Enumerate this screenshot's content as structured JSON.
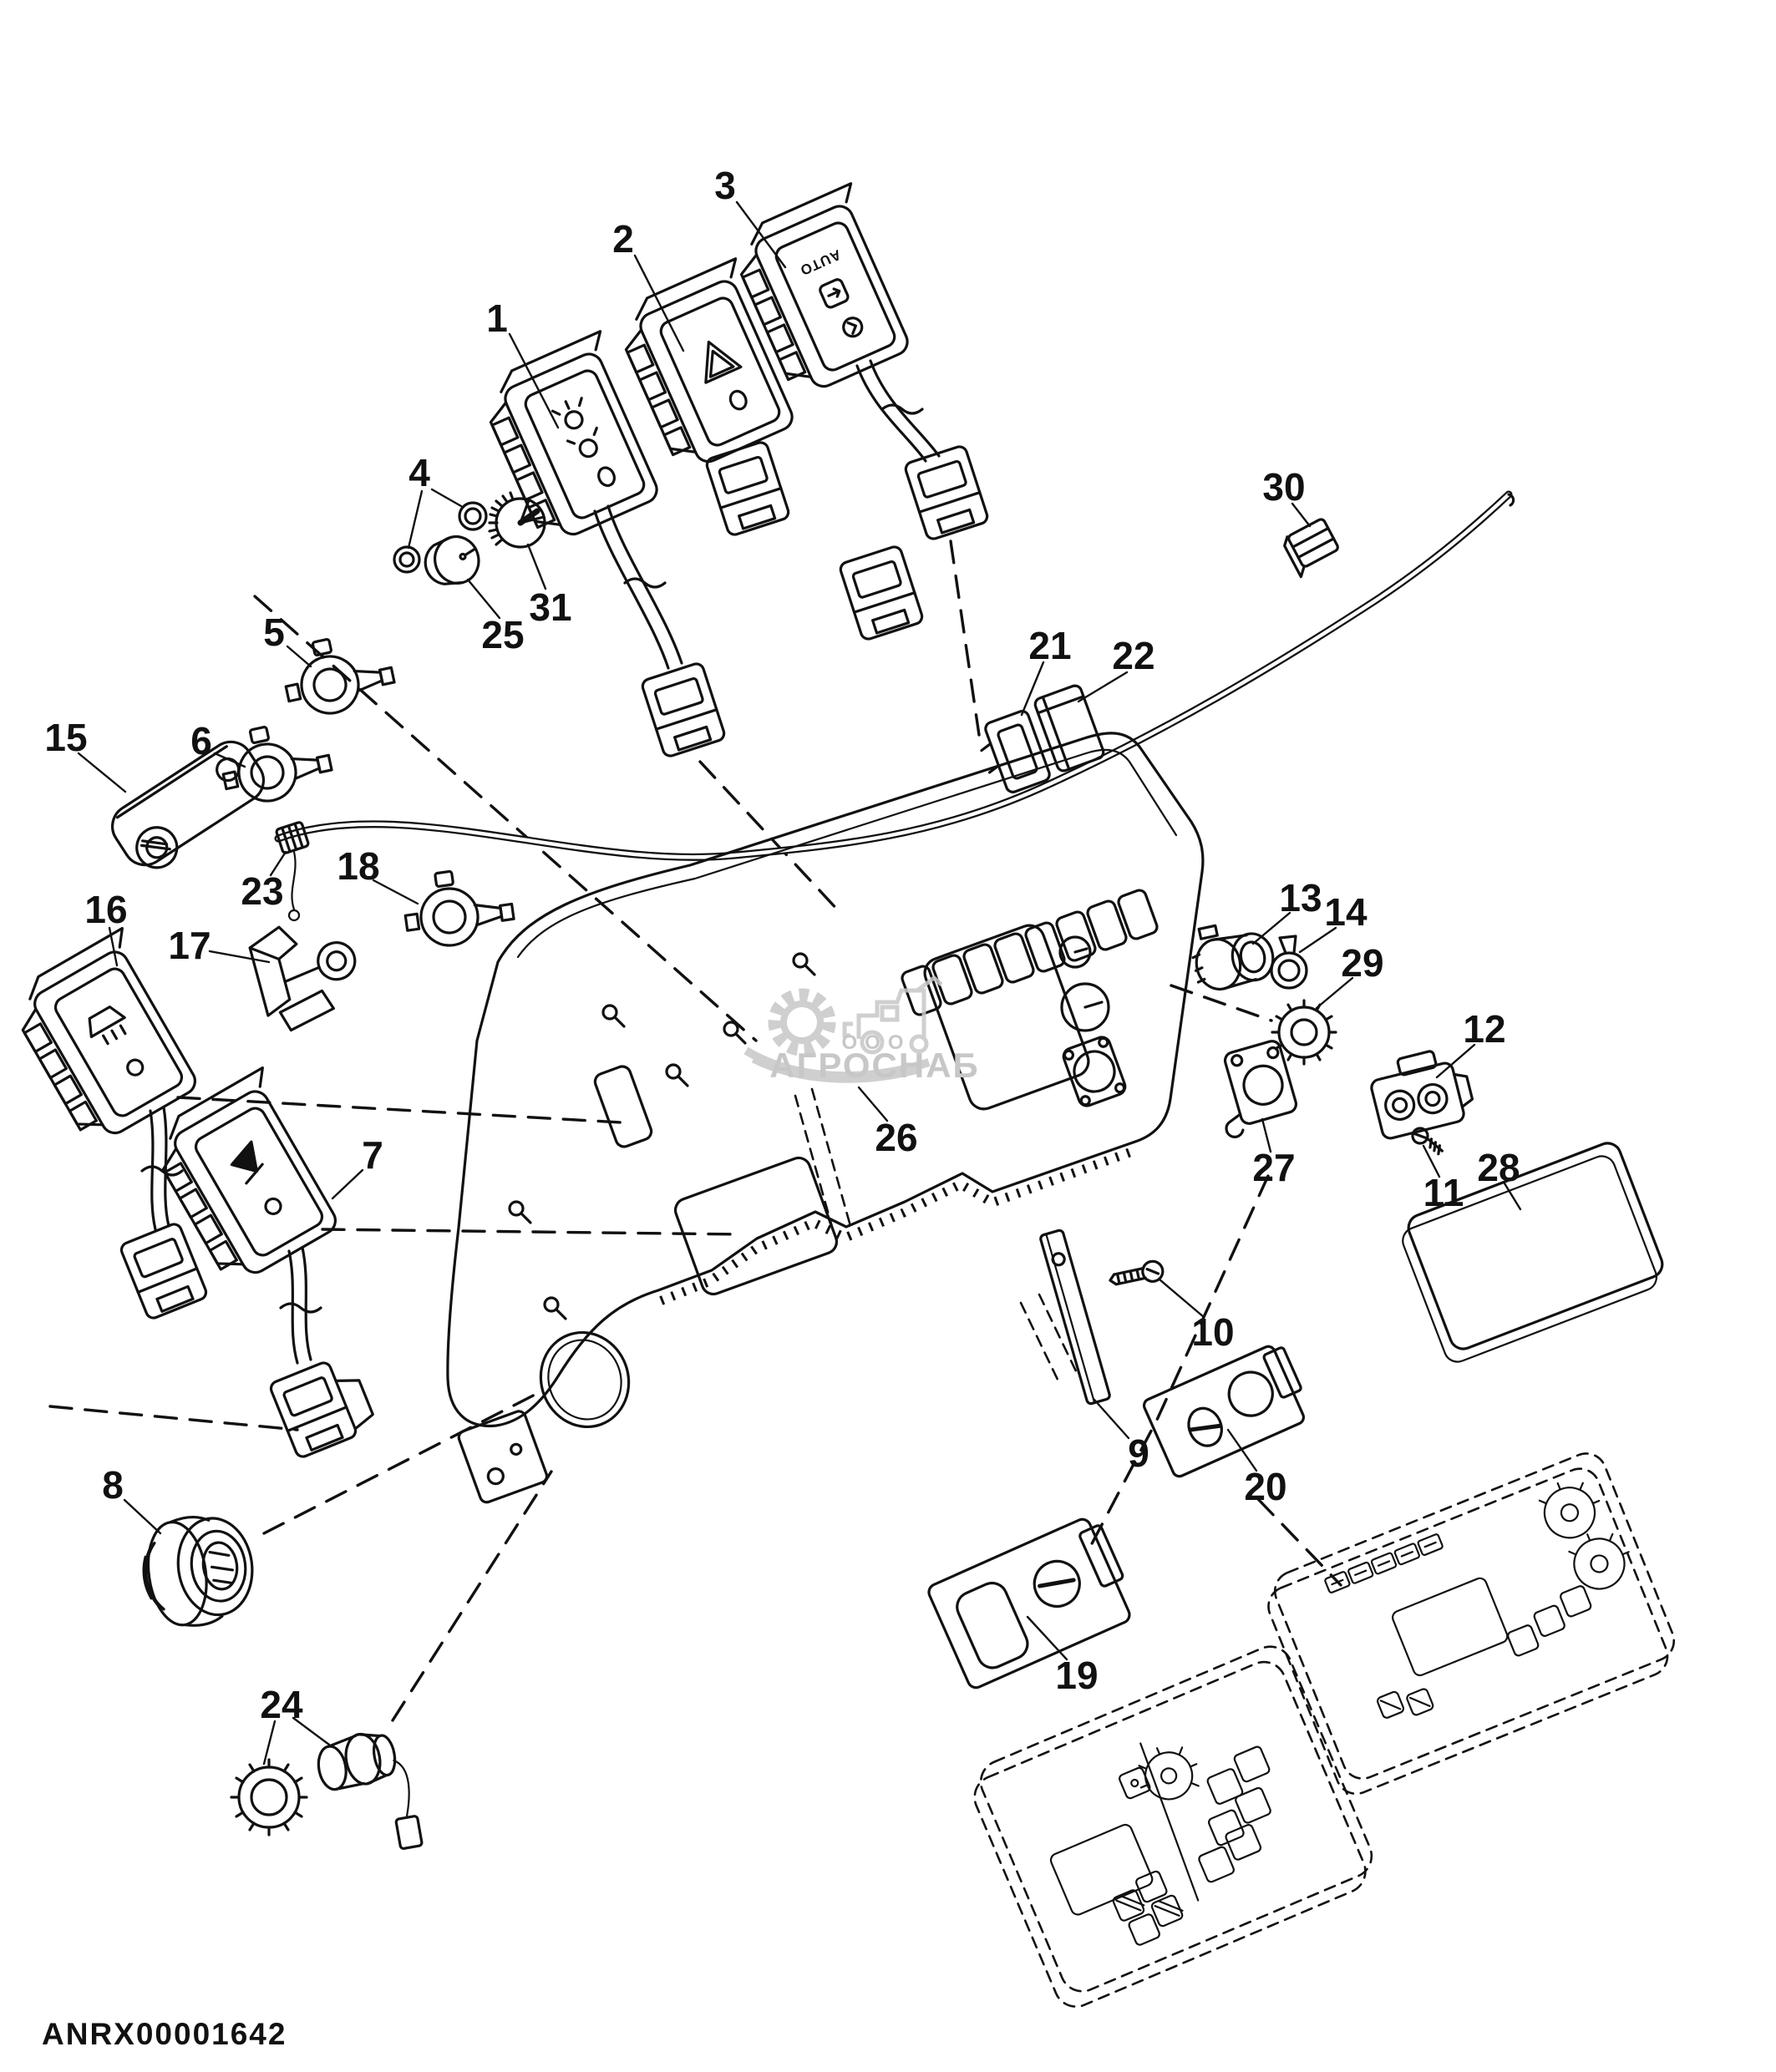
{
  "diagram": {
    "footer_code": "ANRX00001642",
    "watermark": {
      "org": "ООО",
      "name": "АГРОСНАБ"
    },
    "switch3_label": "AUTO",
    "callouts": [
      "1",
      "2",
      "3",
      "4",
      "5",
      "6",
      "7",
      "8",
      "9",
      "10",
      "11",
      "12",
      "13",
      "14",
      "15",
      "16",
      "17",
      "18",
      "19",
      "20",
      "21",
      "22",
      "23",
      "24",
      "25",
      "26",
      "27",
      "28",
      "29",
      "30",
      "31"
    ]
  },
  "colors": {
    "line": "#111111",
    "background": "#ffffff",
    "watermark": "#c7c7c7"
  }
}
